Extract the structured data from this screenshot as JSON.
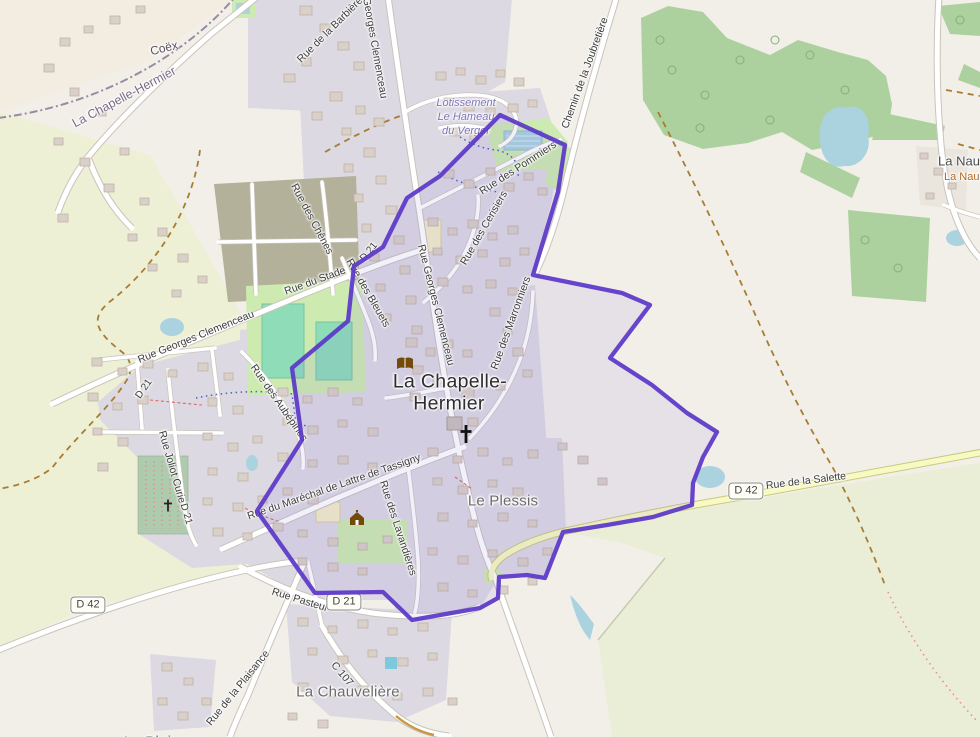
{
  "places": {
    "coex": "Coëx",
    "commune_boundary": "La Chapelle-Hermier",
    "town_line1": "La Chapelle-",
    "town_line2": "Hermier",
    "lotissement_line1": "Lotissement",
    "lotissement_line2": "Le Hameau",
    "lotissement_line3": "du Verger",
    "le_plessis": "Le Plessis",
    "la_chauveliere": "La Chauvelière",
    "la_plaisance": "La Plaisance",
    "la_nauliere": "La Naulière",
    "la_nauliere_farm": "La Naulière"
  },
  "roads": {
    "barbiere": "Rue de la Barbière",
    "clemenceau_top": "Georges Clemenceau",
    "joubretiere": "Chemin de la Joubretière",
    "pommiers": "Rue des Pommiers",
    "cerisiers": "Rue des Cerisiers",
    "bleuets": "Rue des Bleuets",
    "clemenceau_mid": "Rue Georges Clemenceau",
    "clemenceau_west": "Rue Georges Clemenceau",
    "marronniers": "Rue des Marronniers",
    "chenes": "Rue des Chênes",
    "stade": "Rue du Stade",
    "aubepines": "Rue des Aubépines",
    "joliot_curie": "Rue Joliot Curie",
    "tassigny": "Rue du Maréchal de Lattre de Tassigny",
    "lavandieres": "Rue des Lavandières",
    "pasteur": "Rue Pasteur",
    "plaisance": "Rue de la Plaisance",
    "c107": "C 107",
    "salette": "Rue de la Salette"
  },
  "refs": {
    "d42": "D 42",
    "d21": "D 21"
  },
  "icons": {
    "church": "christian-cross",
    "town_hall": "town-hall-building",
    "library": "open-book",
    "cemetery": "small-cross"
  },
  "colors": {
    "selection_boundary": "#5b38c8",
    "selection_fill": "rgba(108,80,208,0.085)",
    "admin_boundary": "#8e7f9b",
    "water": "#aad3df",
    "forest": "#add19e",
    "grass": "#cdebb0",
    "farmland": "#eef0d5",
    "residential": "#dcd9e2",
    "building": "#d9d0c9",
    "road": "#ffffff",
    "tertiary_road": "#f7fac2",
    "track": "#a87d33"
  }
}
